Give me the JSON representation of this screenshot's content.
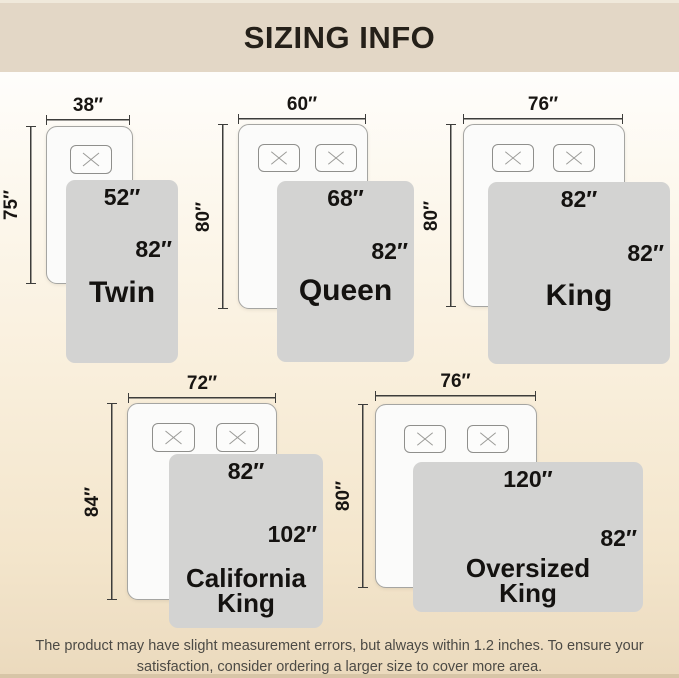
{
  "header": {
    "title": "SIZING INFO"
  },
  "beds": [
    {
      "id": "twin",
      "name": "Twin",
      "mattress_width": "38″",
      "mattress_length": "75″",
      "blanket_width": "52″",
      "blanket_length": "82″",
      "pillows": 1
    },
    {
      "id": "queen",
      "name": "Queen",
      "mattress_width": "60″",
      "mattress_length": "80″",
      "blanket_width": "68″",
      "blanket_length": "82″",
      "pillows": 2
    },
    {
      "id": "king",
      "name": "King",
      "mattress_width": "76″",
      "mattress_length": "80″",
      "blanket_width": "82″",
      "blanket_length": "82″",
      "pillows": 2
    },
    {
      "id": "california-king",
      "name": "California King",
      "mattress_width": "72″",
      "mattress_length": "84″",
      "blanket_width": "82″",
      "blanket_length": "102″",
      "pillows": 2
    },
    {
      "id": "oversized-king",
      "name": "Oversized King",
      "mattress_width": "76″",
      "mattress_length": "80″",
      "blanket_width": "120″",
      "blanket_length": "82″",
      "pillows": 2
    }
  ],
  "footer": {
    "line1": "The product may have slight measurement errors, but always within 1.2 inches. To ensure your",
    "line2": "satisfaction, consider ordering a larger size to cover more area."
  },
  "colors": {
    "header_bg": "#e3d7c6",
    "page_top": "#fefdfb",
    "page_bottom": "#ebdabd",
    "blanket": "#d3d3d2",
    "mattress": "#fbfbfa",
    "dimension_line": "#3d3d3b",
    "text": "#141210",
    "footer_text": "#4c4a45"
  }
}
